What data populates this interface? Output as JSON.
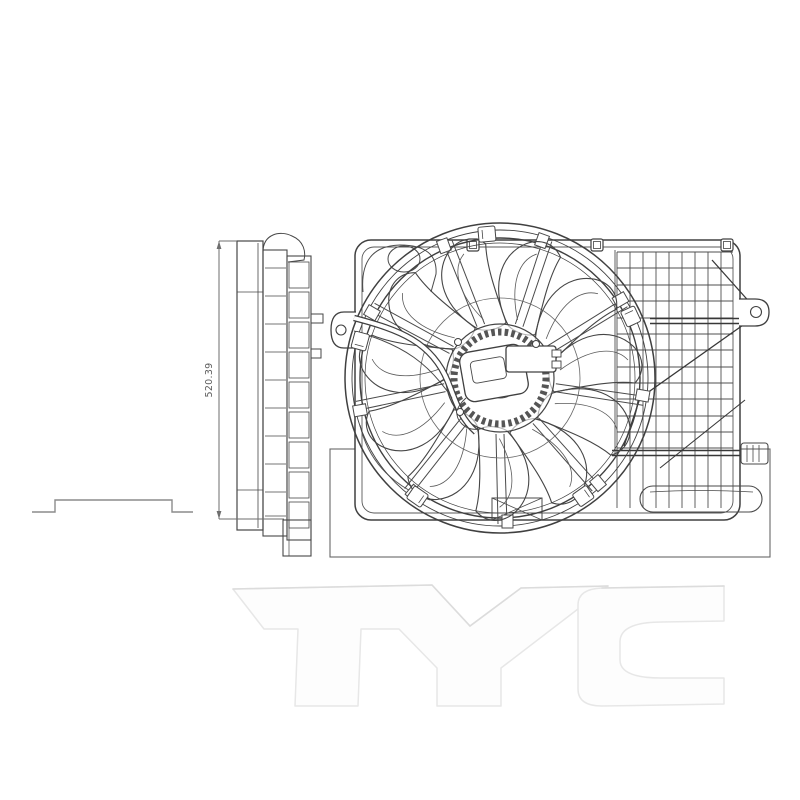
{
  "page": {
    "background": "#ffffff",
    "description": "technical line drawing of an engine cooling fan shroud assembly"
  },
  "drawing": {
    "line_color": "#404040",
    "thin_line_color": "#6e6e6e",
    "views": {
      "side_view": {
        "name": "side profile view",
        "dimension_label": "520.39"
      },
      "front_view": {
        "name": "front view of fan shroud with fan blade and motor"
      },
      "bracket_profile": {
        "name": "mounting bracket step profile"
      }
    },
    "watermark": {
      "text": "TYC",
      "fill": "#fdfdfd",
      "edge": "#e7e7e7",
      "shade": "#d9d9d9"
    }
  }
}
